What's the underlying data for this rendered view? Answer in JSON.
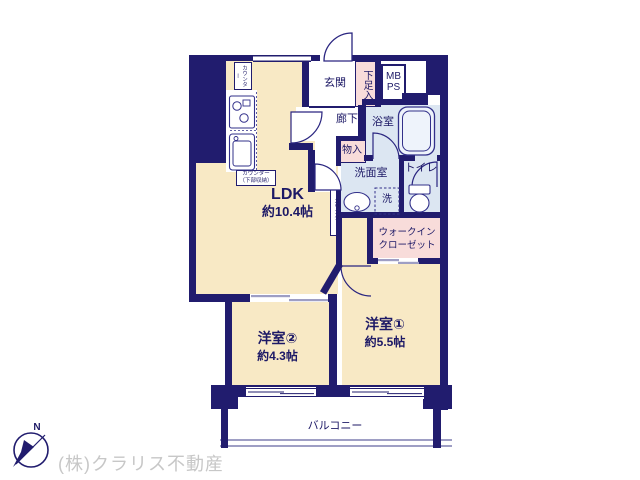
{
  "title": "マンション間取り図",
  "colors": {
    "wall": "#211c6e",
    "room_cream": "#f8e9c5",
    "wet_area_blue": "#dce6f2",
    "closet_pink": "#f8dcda",
    "label_navy": "#1d1966",
    "slider_gray": "#9e9ec4",
    "watermark_gray": "#c7c7c7"
  },
  "rooms": {
    "ldk": {
      "label": "LDK",
      "size": "約10.4帖"
    },
    "bedroom1": {
      "label": "洋室①",
      "size": "約5.5帖"
    },
    "bedroom2": {
      "label": "洋室②",
      "size": "約4.3帖"
    },
    "entrance": {
      "label": "玄関"
    },
    "shoe_cabinet": {
      "label": "下足入"
    },
    "meter_pipe_space": {
      "label": "MB\nPS"
    },
    "hallway": {
      "label": "廊下"
    },
    "bathroom": {
      "label": "浴室"
    },
    "storage": {
      "label": "物入"
    },
    "washroom": {
      "label": "洗面室"
    },
    "washer": {
      "label": "洗"
    },
    "toilet": {
      "label": "トイレ"
    },
    "walk_in_closet": {
      "label": "ウォークイン\nクローゼット"
    },
    "balcony": {
      "label": "バルコニー"
    },
    "kitchen_counter_top": {
      "label": "カウンター"
    },
    "kitchen_counter": {
      "label": "カウンター\n（下部収納）"
    },
    "side_counter": {
      "label": "カウンター"
    }
  },
  "compass": {
    "north": "N"
  },
  "watermark": {
    "text": "(株)クラリス不動産"
  }
}
